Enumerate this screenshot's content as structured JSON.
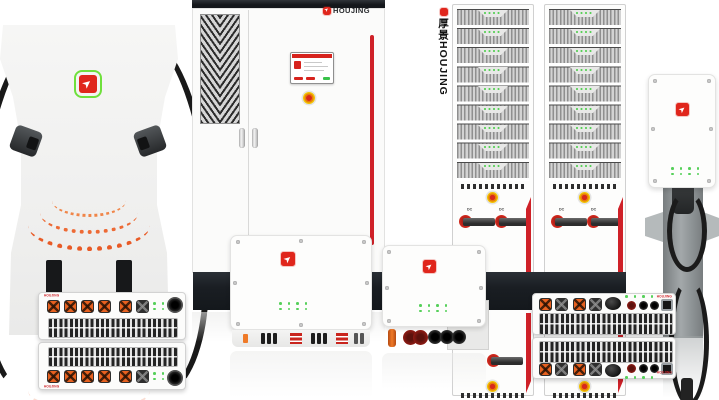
{
  "brand": {
    "name": "HOUJING",
    "vertical_name": "厚景HOUJING"
  },
  "labels": {
    "dc": "DC"
  },
  "icons": {
    "arrow_glyph": "➤"
  },
  "colors": {
    "background": "#ffffff",
    "accent_red": "#cf2128",
    "logo_red": "#e0261c",
    "logo_green": "#6fe03c",
    "connector_orange": "#e8611f",
    "led_green": "#56d05a",
    "estop_yellow": "#f2c200",
    "dark_base": "#1a1e23",
    "pedestal_gray": "#8f9496",
    "cabinet_white": "#fbfbfa"
  }
}
